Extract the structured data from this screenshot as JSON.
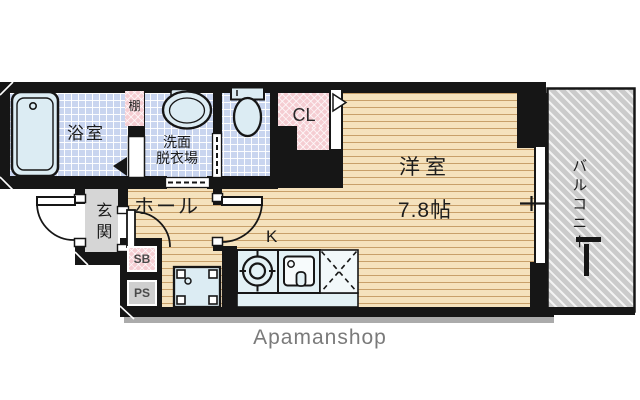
{
  "plan": {
    "bathroom": {
      "label": "浴室"
    },
    "shelf": {
      "label": "棚"
    },
    "washroom": {
      "line1": "洗面",
      "line2": "脱衣場"
    },
    "closet": {
      "label": "CL"
    },
    "western_room": {
      "label": "洋室",
      "size": "7.8帖"
    },
    "balcony": {
      "label": "バルコニー"
    },
    "entrance": {
      "label": "玄関"
    },
    "hall": {
      "label": "ホール"
    },
    "kitchen": {
      "label": "K"
    },
    "shoe_box": {
      "label": "SB"
    },
    "pipe_space": {
      "label": "PS"
    }
  },
  "footer": {
    "brand": "Apamanshop"
  },
  "colors": {
    "wall": "#161616",
    "tile_floor": "#c9d5ef",
    "wood_floor": "#f5e2bd",
    "wood_line": "#c8a06a",
    "closet_pink": "#f5cdd2",
    "balcony_gray": "#cbcbcb",
    "fixture_fill": "#dcecf3",
    "entrance_gray": "#d6d6d6",
    "brand_text": "#7a7a7a"
  },
  "fixtures": [
    "bathtub",
    "wash-basin",
    "toilet",
    "bath-door",
    "washroom-sliding-door",
    "toilet-sliding-door",
    "closet-door",
    "entrance-door",
    "room-door",
    "hall-door",
    "washing-machine-pan",
    "stove-burner",
    "kitchen-sink",
    "refrigerator-space",
    "kitchen-counter",
    "balcony-window",
    "window-handle",
    "balcony-drain"
  ]
}
